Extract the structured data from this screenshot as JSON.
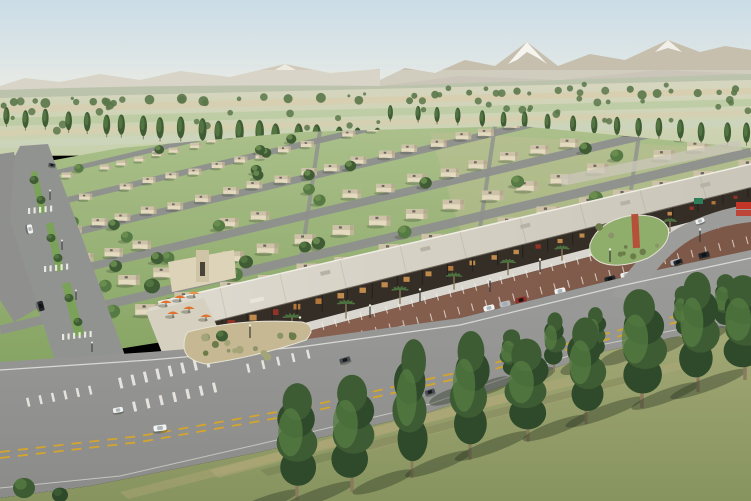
{
  "scene": {
    "description": "Aerial 3D architectural rendering of a desert master-planned community: rows of flat-roof beige villas on green lawns, a long canopy-roofed retail strip with palm trees and an orange-umbrella patio, a red-brown parking lot with parked cars, a wide boulevard with planted medians, a main road with yellow dashed lanes and crosswalks, farmland and mountains with one snow-capped peak on the horizon, and a foreground field with rows of tall trees casting shadows.",
    "regions": [
      {
        "name": "sky",
        "label": "pale blue sky"
      },
      {
        "name": "mountain-range",
        "label": "tan mountain ridge"
      },
      {
        "name": "snow-peak",
        "label": "snow-capped peak"
      },
      {
        "name": "farmland",
        "label": "striped crop fields with tree lines"
      },
      {
        "name": "poplar-row",
        "label": "rows of columnar trees"
      },
      {
        "name": "residential-neighborhood",
        "label": "rows of beige flat-roof villas"
      },
      {
        "name": "boulevard",
        "label": "landscaped boulevard with medians"
      },
      {
        "name": "retail-strip",
        "label": "canopy-roof retail strip with storefronts"
      },
      {
        "name": "patio-umbrellas",
        "label": "orange cafe umbrellas"
      },
      {
        "name": "parking-lot",
        "label": "red-brown striped parking lot"
      },
      {
        "name": "main-road",
        "label": "main road with yellow dashed centerline"
      },
      {
        "name": "median-island",
        "label": "desert-planted median island"
      },
      {
        "name": "roundabout-island",
        "label": "green island with red sculpture"
      },
      {
        "name": "foreground-field",
        "label": "grass field with tall tree rows"
      }
    ],
    "palette": {
      "sky_top": "#cbdce7",
      "sky_horizon": "#eaece6",
      "mountain_left": "#d1cabb",
      "mountain_right": "#c6bfae",
      "mountain_shadow": "#b3ac9b",
      "snow": "#f6f4ee",
      "foothills": "#a9b295",
      "haze": "#e8ebe4",
      "field_top": "#d7d6c0",
      "field_bottom": "#c7d1ac",
      "field_tan": "#d8ceaf",
      "field_green": "#b9caa0",
      "field_pale": "#cdd6c2",
      "tree_distant": "#5a774a",
      "tree_dark": "#3f5c35",
      "tree_mid": "#567a44",
      "tree_light": "#6f9252",
      "lawn_near": "#86a463",
      "lawn_far": "#abc08b",
      "ground_tan": "#c8c09a",
      "house_wall": "#e4dabf",
      "house_roof": "#cdc2a8",
      "house_shade": "#a2967a",
      "house_unit": "#6b675f",
      "street": "#8f908e",
      "boulevard": "#919391",
      "curb": "#d8d6ce",
      "median_green": "#7aa258",
      "canopy_light": "#dedacf",
      "canopy_dark": "#c9c5b8",
      "fascia": "#6e675c",
      "storefront": "#342e27",
      "light_warm": "#d89a52",
      "light_amber": "#c9833f",
      "light_red": "#a33428",
      "sign_white": "#e8e4da",
      "plaza": "#d6d0c0",
      "umbrella_orange": "#e0722e",
      "palm_green": "#4d7240",
      "trunk_brown": "#8a7a5e",
      "back_building": "#ddd3b8",
      "tower": "#cfc4a6",
      "lot_left": "#8a6251",
      "lot_right": "#7c5848",
      "stripe_white": "#f3f1ea",
      "road_light": "#9c9c9a",
      "road_dark": "#8b8b89",
      "lane_yellow": "#d3a52c",
      "line_white": "#e9e9e5",
      "island_sand": "#c6b892",
      "shrub_olive": "#6b7c4a",
      "shrub_sage": "#8a936a",
      "shrub_tan": "#a3a478",
      "roundabout_green": "#8fae6c",
      "sculpture_red": "#b5503a",
      "fg_field_top": "#a3a876",
      "fg_field_bottom": "#87945f",
      "streak_tan": "#b9ad7e",
      "streak_dark": "#5f6d45",
      "fg_tree": "#3e5c34",
      "fg_tree_light": "#567c42",
      "fg_tree_dark": "#2f4a2a",
      "car_white": "#f2f3f1",
      "car_black": "#24272b",
      "car_silver": "#b8bbbf",
      "car_red": "#8e2f28",
      "car_gray": "#4a4e52",
      "sign_red": "#c23527",
      "sign_green": "#2e7d5b",
      "pole_dark": "#3a3a38",
      "shadow_green": "#26331f"
    },
    "counts": {
      "umbrellas": 6,
      "palm_trees": 9,
      "canopy_posts": 24,
      "shop_lights": 26,
      "foreground_trees": 9,
      "back_field_trees": 7,
      "poplar_row_left": 20,
      "poplar_row_right": 17,
      "distant_trees": 60,
      "residential_trees": 46,
      "island_shrubs": 14,
      "roundabout_shrubs": 8
    },
    "parked_car_colors": [
      "car_black",
      "car_white",
      "car_silver",
      "car_gray",
      "car_white",
      "car_white",
      "car_silver",
      "car_red",
      "car_white",
      "car_black",
      "car_white",
      "car_silver",
      "car_black"
    ],
    "road_car_colors": [
      "car_white",
      "car_gray",
      "car_black",
      "car_white",
      "car_white",
      "car_black",
      "car_gray"
    ]
  }
}
